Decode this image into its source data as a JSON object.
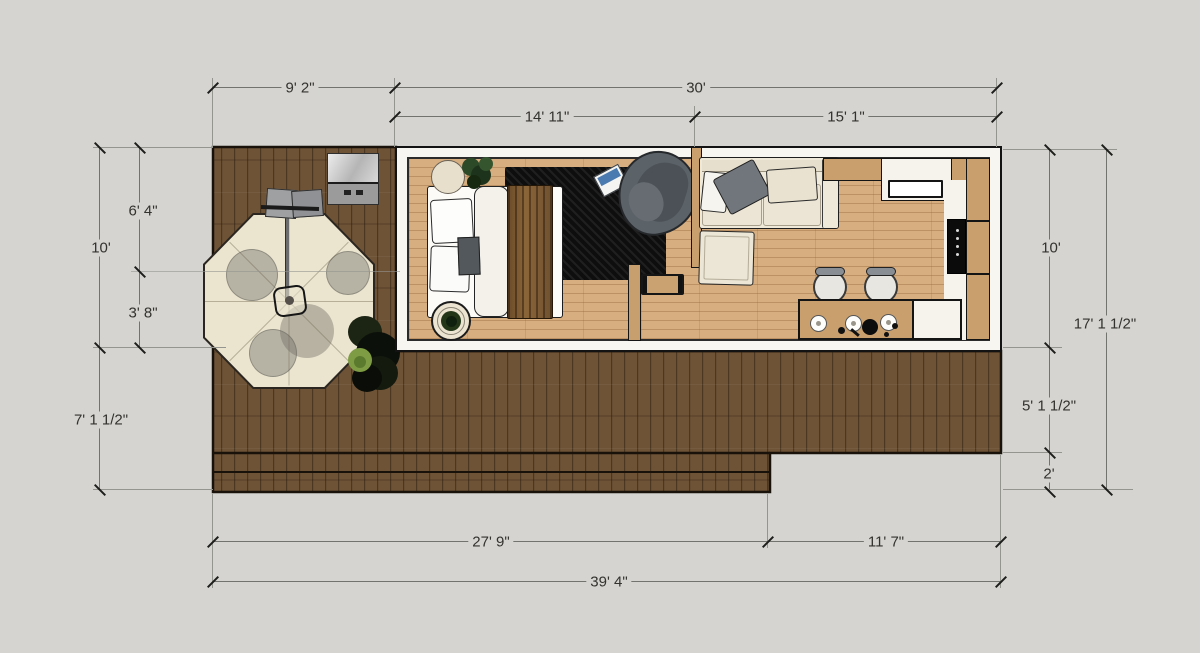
{
  "drawing": {
    "type": "floor-plan-top-view",
    "subject": "tiny house with wood deck, patio table, bedroom, living room and kitchen"
  },
  "dimensions": {
    "top": {
      "deck": "9' 2\"",
      "house": "30'",
      "bedroom": "14' 11\"",
      "living": "15' 1\""
    },
    "left": {
      "upper": "6' 4\"",
      "house": "10'",
      "lower": "3' 8\"",
      "deck": "7' 1 1/2\""
    },
    "right": {
      "house": "10'",
      "total": "17' 1 1/2\"",
      "deck": "5' 1 1/2\"",
      "steps": "2'"
    },
    "bottom": {
      "deck": "27' 9\"",
      "house": "11' 7\"",
      "total": "39' 4\""
    }
  },
  "colors": {
    "background": "#d5d4d1",
    "deck_wood": "#6e5336",
    "interior_floor": "#d6ae80",
    "wall": "#f8f6f1",
    "cabinet_wood": "#c99f6e",
    "rug": "#0e0e0e",
    "sofa_cream": "#efe9da",
    "dimension_text": "#33322e"
  }
}
